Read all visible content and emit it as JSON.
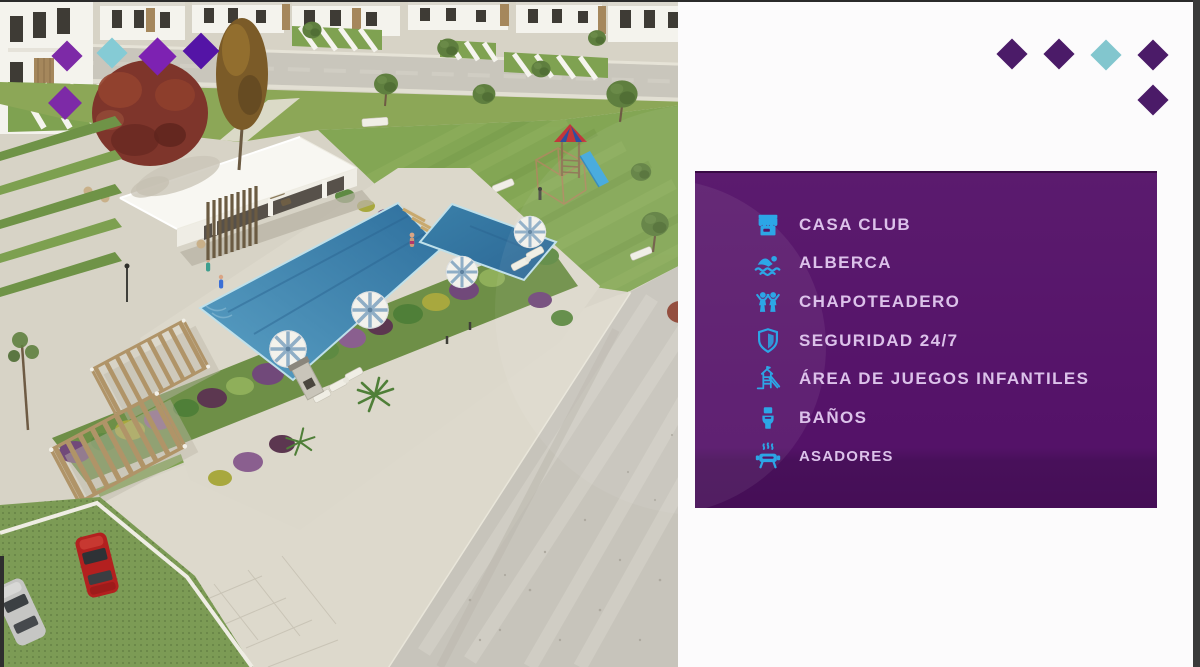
{
  "amenities_panel": {
    "items": [
      {
        "icon": "storefront-icon",
        "label": "CASA CLUB"
      },
      {
        "icon": "swimmer-icon",
        "label": "ALBERCA"
      },
      {
        "icon": "children-icon",
        "label": "CHAPOTEADERO"
      },
      {
        "icon": "shield-icon",
        "label": "SEGURIDAD 24/7"
      },
      {
        "icon": "playground-icon",
        "label": "ÁREA DE JUEGOS INFANTILES"
      },
      {
        "icon": "toilet-icon",
        "label": "BAÑOS"
      },
      {
        "icon": "grill-icon",
        "label": "ASADORES"
      }
    ]
  },
  "photo": {
    "alt": "Aerial 3D render of a residential community: clubhouse, swimming pool with umbrellas, gardens, playground, road and parked cars"
  },
  "theme": {
    "panel_bg": "#551369",
    "panel_bg_bottom": "#450E56",
    "icon_color": "#2CA6E6",
    "label_color": "#DCC2EA",
    "diamond_colors": {
      "purple-bright": "#7D2AA7",
      "purple-vivid": "#7D22B2",
      "indigo": "#5414A6",
      "teal-light": "#85CBD5",
      "teal-soft": "#82C6CE",
      "purple-dark": "#4B1B68"
    }
  }
}
